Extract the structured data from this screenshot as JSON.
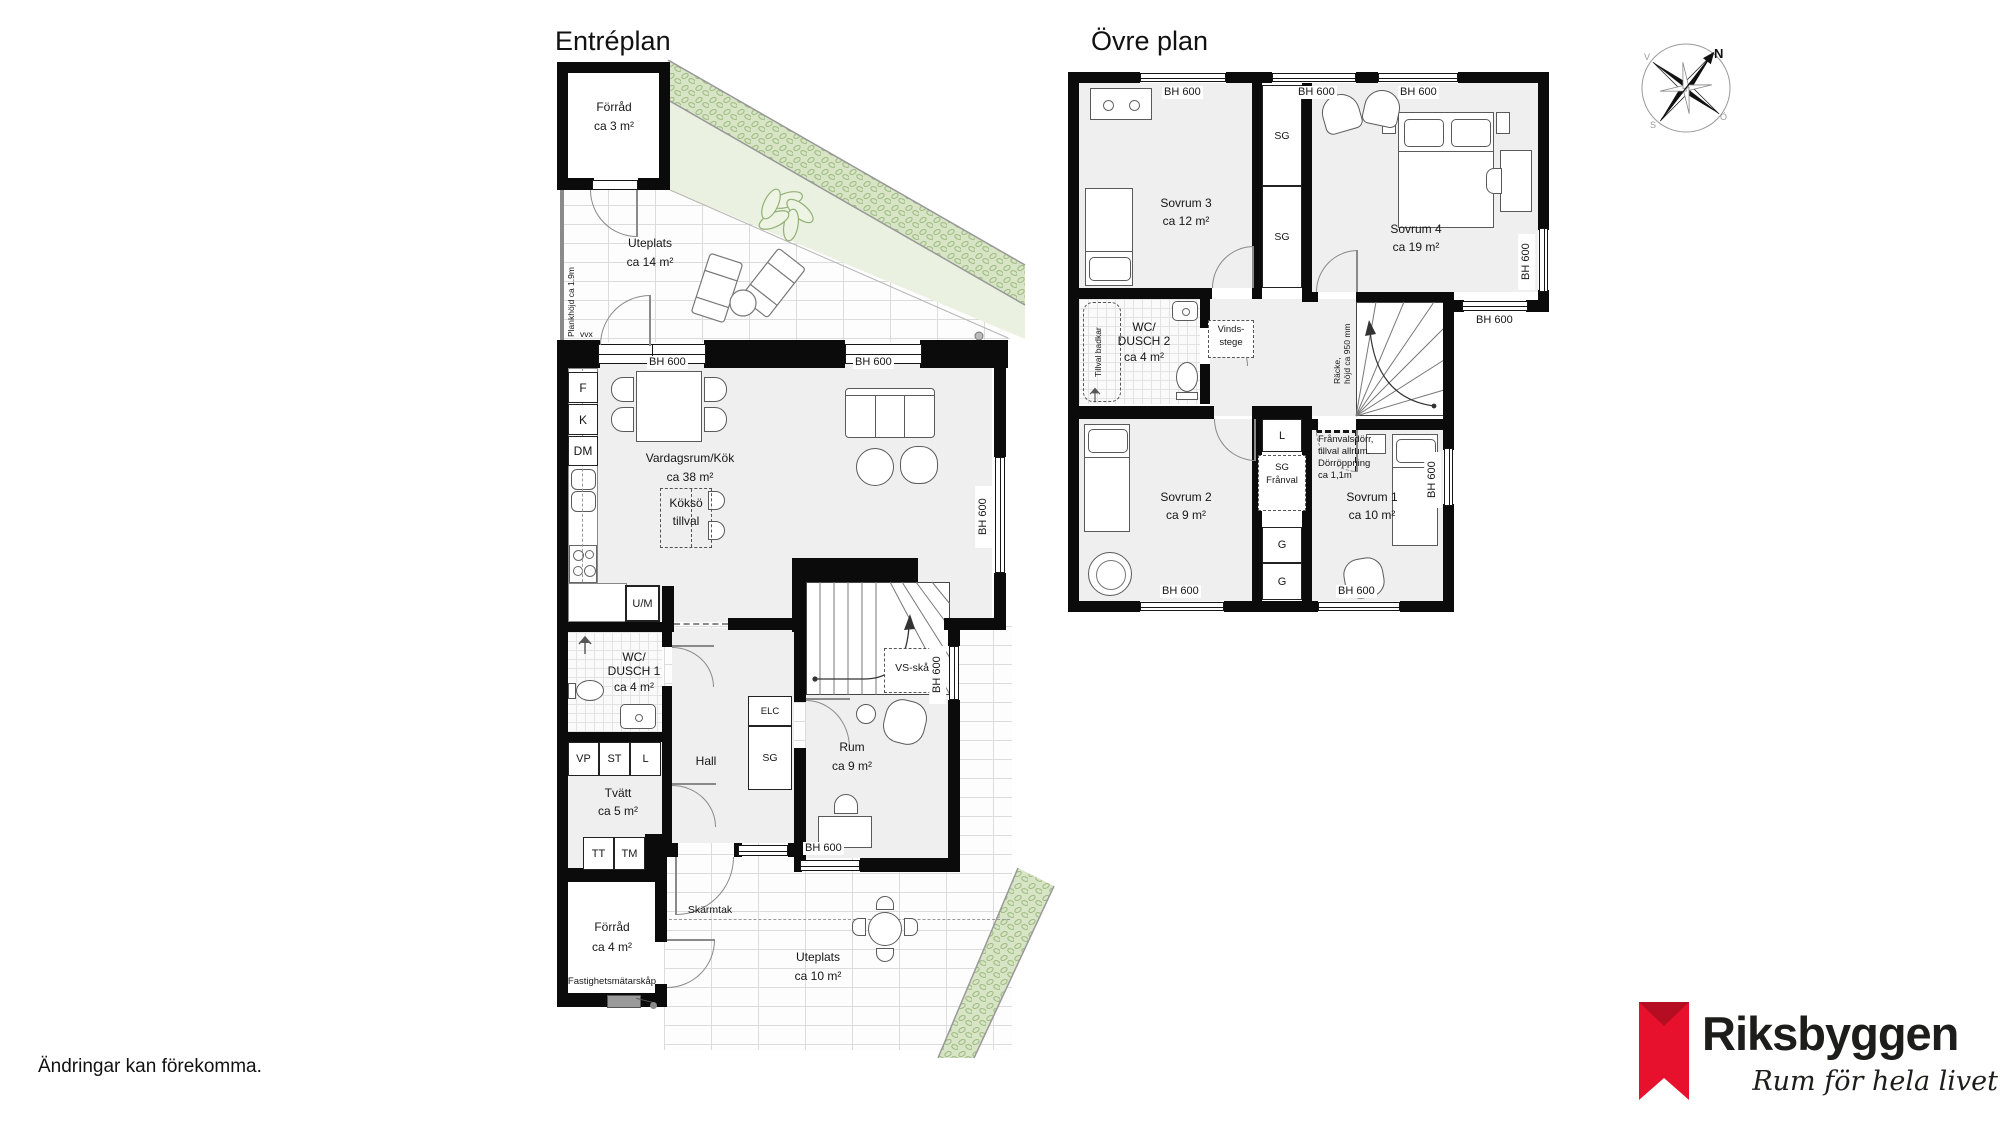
{
  "disclaimer": "Ändringar kan förekomma.",
  "brand": {
    "name": "Riksbyggen",
    "tagline": "Rum för hela livet",
    "red": "#e8112d"
  },
  "compass": {
    "n": "N",
    "s": "S",
    "w": "V",
    "e": "Ö"
  },
  "win": {
    "label": "BH 600"
  },
  "entreplan": {
    "title": "Entréplan",
    "rooms": {
      "forrad3": {
        "name": "Förråd",
        "area": "ca 3 m²"
      },
      "uteplats14": {
        "name": "Uteplats",
        "area": "ca 14 m²"
      },
      "vardagsrum": {
        "name": "Vardagsrum/Kök",
        "area": "ca 38 m²"
      },
      "wc1": {
        "l1": "WC/",
        "l2": "DUSCH 1",
        "area": "ca 4 m²"
      },
      "rum9": {
        "name": "Rum",
        "area": "ca 9 m²"
      },
      "hall": {
        "name": "Hall"
      },
      "tvatt": {
        "name": "Tvätt",
        "area": "ca 5 m²"
      },
      "forrad4": {
        "name": "Förråd",
        "area": "ca 4 m²"
      },
      "uteplats10": {
        "name": "Uteplats",
        "area": "ca 10 m²"
      }
    },
    "ann": {
      "plankhojd": "Plankhöjd ca 1.9m",
      "vvx": "vvx",
      "kokso1": "Köksö",
      "kokso2": "tillval",
      "f": "F",
      "k": "K",
      "dm": "DM",
      "um": "U/M",
      "vp": "VP",
      "st": "ST",
      "l": "L",
      "tt": "TT",
      "tm": "TM",
      "elc": "ELC",
      "sg": "SG",
      "vs": "VS-skåp",
      "skarmtak": "Skärmtak",
      "fastighet": "Fastighetsmätarskåp"
    }
  },
  "ovreplan": {
    "title": "Övre plan",
    "rooms": {
      "sovrum3": {
        "name": "Sovrum 3",
        "area": "ca 12 m²"
      },
      "sovrum4": {
        "name": "Sovrum 4",
        "area": "ca 19 m²"
      },
      "wc2": {
        "l1": "WC/",
        "l2": "DUSCH 2",
        "area": "ca 4 m²"
      },
      "sovrum2": {
        "name": "Sovrum 2",
        "area": "ca 9 m²"
      },
      "sovrum1": {
        "name": "Sovrum 1",
        "area": "ca 10 m²"
      }
    },
    "ann": {
      "sg": "SG",
      "l": "L",
      "g": "G",
      "tillval_badkar": "Tillval badkar",
      "vinds1": "Vinds-",
      "vinds2": "stege",
      "racke1": "Räcke,",
      "racke2": "höjd ca 950 mm",
      "franval1": "Frånvalsdörr,",
      "franval2": "tillval allrum.",
      "franval3": "Dörröppning",
      "franval4": "ca 1,1m",
      "sgf1": "SG",
      "sgf2": "Frånval"
    }
  }
}
